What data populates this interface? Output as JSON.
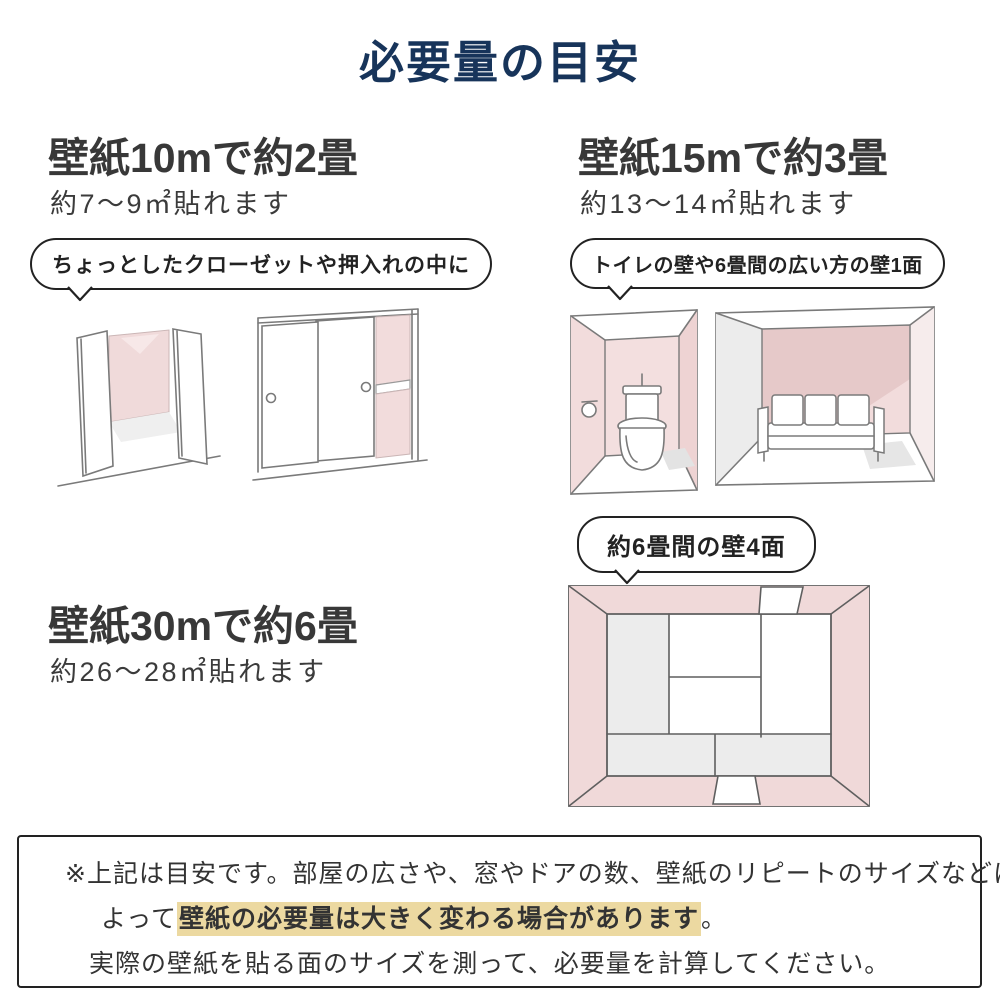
{
  "title": "必要量の目安",
  "palette": {
    "title_navy": "#17345a",
    "text_dark": "#383838",
    "wall_pink": "#f2dcdc",
    "wall_pink_dark": "#e6c9c9",
    "floor_gray": "#ececec",
    "highlight_tan": "#ecd9a1",
    "sketch_line": "#7a7a7a"
  },
  "sections": [
    {
      "heading": "壁紙10mで約2畳",
      "subtext": "約7〜9㎡貼れます",
      "bubble": "ちょっとしたクローゼットや押入れの中に",
      "illustrations": [
        "open-closet-sketch",
        "sliding-closet-sketch"
      ]
    },
    {
      "heading": "壁紙15mで約3畳",
      "subtext": "約13〜14㎡貼れます",
      "bubble": "トイレの壁や6畳間の広い方の壁1面",
      "illustrations": [
        "toilet-room-sketch",
        "sofa-room-sketch"
      ]
    },
    {
      "heading": "壁紙30mで約6畳",
      "subtext": "約26〜28㎡貼れます",
      "bubble": "約6畳間の壁4面",
      "illustrations": [
        "six-tatami-room-top-view-sketch"
      ]
    }
  ],
  "note": {
    "line1": "※上記は目安です。部屋の広さや、窓やドアの数、壁紙のリピートのサイズなどに",
    "line2_prefix": "よって",
    "line2_highlight": "壁紙の必要量は大きく変わる場合があります",
    "line2_suffix": "。",
    "line3": "実際の壁紙を貼る面のサイズを測って、必要量を計算してください。"
  }
}
